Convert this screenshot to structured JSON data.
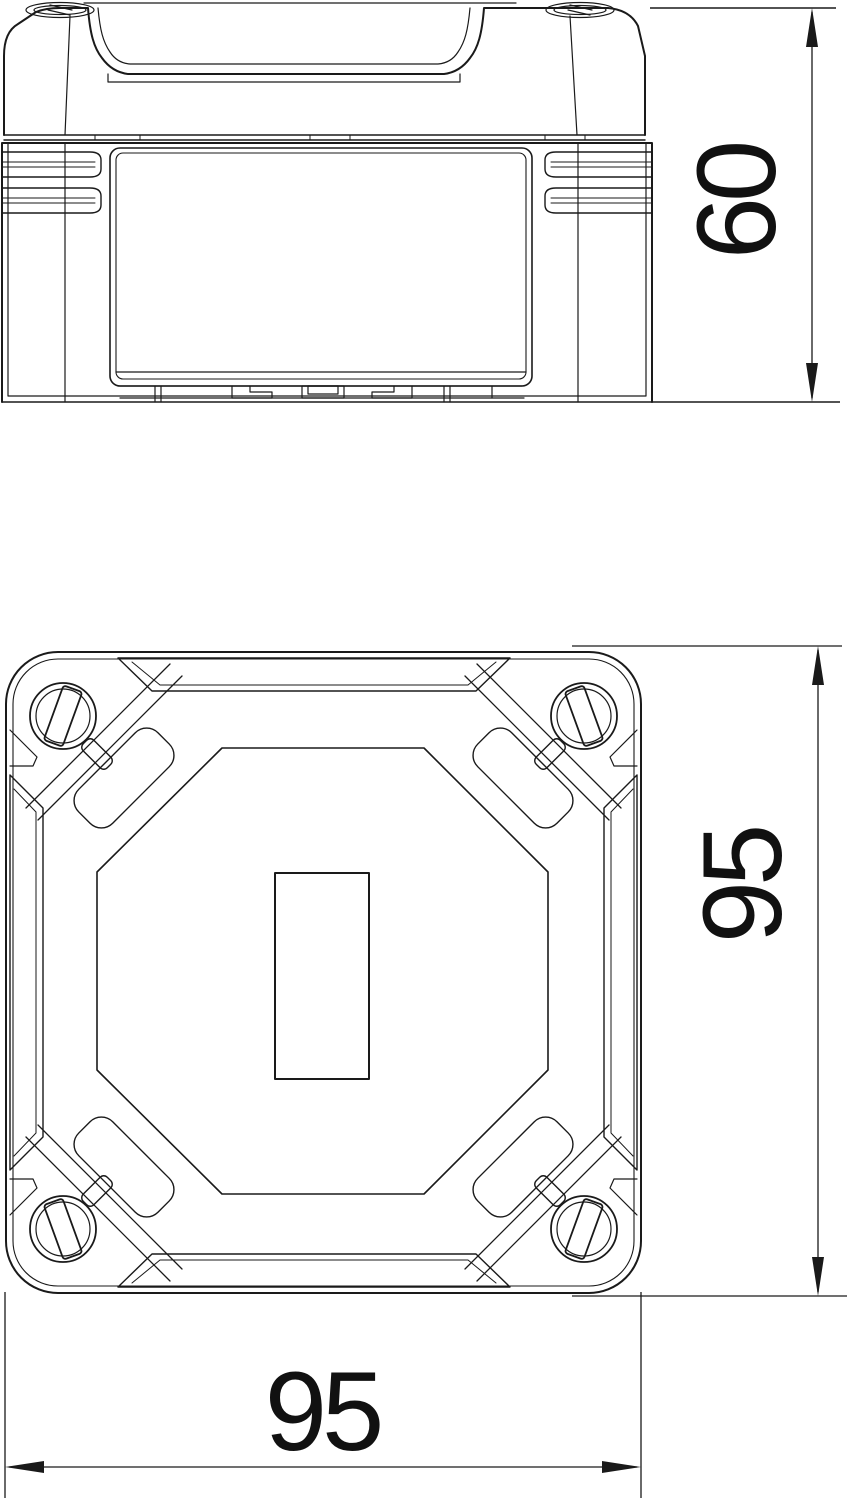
{
  "dimensions": {
    "side_height": "60",
    "plan_height": "95",
    "plan_width": "95"
  },
  "colors": {
    "line": "#1a1a1a",
    "background": "#ffffff"
  }
}
